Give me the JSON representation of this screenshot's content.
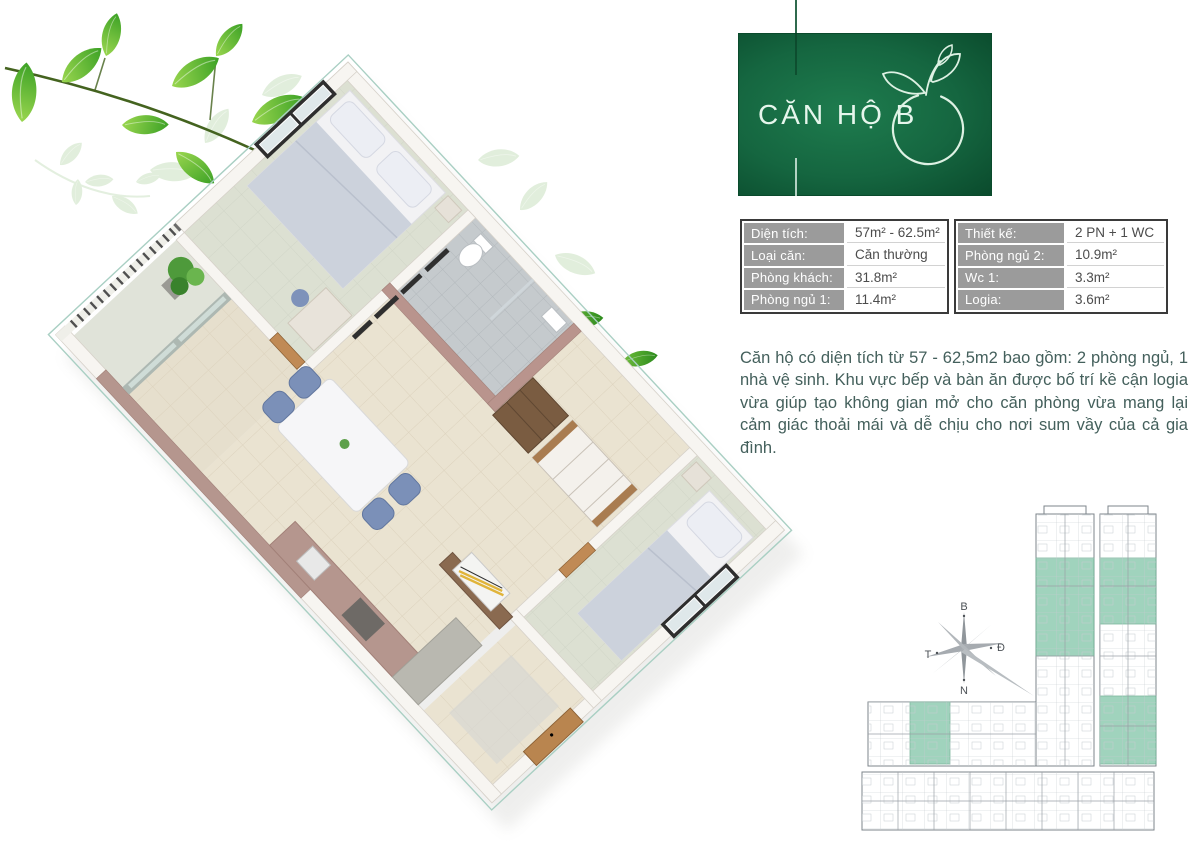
{
  "title_card": {
    "title": "CĂN HỘ B",
    "logo": "leaf-circle-logo",
    "background_color": "#156640",
    "text_color": "#e6f6ec"
  },
  "spec_table": {
    "left": {
      "rows": [
        {
          "label": "Diện tích:",
          "value": "57m² - 62.5m²"
        },
        {
          "label": "Loại căn:",
          "value": "Căn thường"
        },
        {
          "label": "Phòng khách:",
          "value": "31.8m²"
        },
        {
          "label": "Phòng ngủ 1:",
          "value": "11.4m²"
        }
      ]
    },
    "right": {
      "rows": [
        {
          "label": "Thiết kế:",
          "value": "2 PN + 1 WC"
        },
        {
          "label": "Phòng ngủ 2:",
          "value": "10.9m²"
        },
        {
          "label": "Wc 1:",
          "value": "3.3m²"
        },
        {
          "label": "Logia:",
          "value": "3.6m²"
        }
      ]
    },
    "label_bg_color": "#9b9b9b"
  },
  "description": "Căn hộ có diện tích từ 57 - 62,5m2 bao gồm: 2 phòng ngủ, 1 nhà vệ sinh. Khu vực bếp và bàn ăn được bố trí kề cận logia vừa giúp tạo không gian mở cho căn phòng vừa mang lại cảm giác thoải mái và dễ chịu cho nơi sum vầy của cả gia đình.",
  "compass": {
    "north_label": "B",
    "east_label": "Đ",
    "west_label": "T",
    "south_label": "N"
  },
  "floor_plate": {
    "highlight_color": "#96cfb6"
  },
  "colors": {
    "accent_green": "#156640",
    "leaf_green": "#4caf2e",
    "wall_mauve": "#b5968e",
    "floor_beige": "#eae3d1",
    "bedroom_floor": "#dce0d2",
    "bath_gray": "#c5cacd",
    "wood_door": "#c08a55",
    "chair_blue": "#7b90b8"
  }
}
